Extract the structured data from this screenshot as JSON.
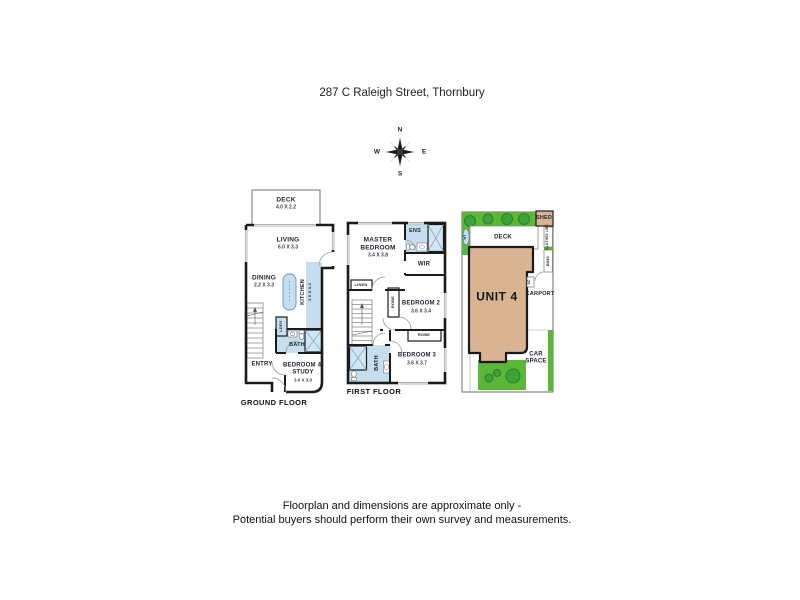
{
  "title": "287 C Raleigh Street, Thornbury",
  "compass": {
    "north": "N",
    "south": "S",
    "east": "E",
    "west": "W"
  },
  "ground_floor": {
    "floor_label": "GROUND FLOOR",
    "deck": {
      "name": "DECK",
      "dims": "4.0 X 2.2"
    },
    "living": {
      "name": "LIVING",
      "dims": "6.0 X 3.3"
    },
    "dining": {
      "name": "DINING",
      "dims": "2.2 X 3.3"
    },
    "kitchen": {
      "name": "KITCHEN",
      "dims": "2.0 X 3.3"
    },
    "laundry": {
      "name": "LDRY"
    },
    "bath": {
      "name": "BATH"
    },
    "entry": {
      "name": "ENTRY"
    },
    "bedroom4_study": {
      "name_line1": "BEDROOM 4/",
      "name_line2": "STUDY",
      "dims": "3.0 X 3.0"
    }
  },
  "first_floor": {
    "floor_label": "FIRST FLOOR",
    "master_bedroom": {
      "name_line1": "MASTER",
      "name_line2": "BEDROOM",
      "dims": "3.4 X 3.8"
    },
    "ensuite": {
      "name": "ENS"
    },
    "wir": {
      "name": "WIR"
    },
    "linen": {
      "name": "LINEN"
    },
    "robe_bedroom2": {
      "name": "ROBE"
    },
    "bedroom2": {
      "name": "BEDROOM 2",
      "dims": "3.6 X 3.4"
    },
    "robe_bedroom3": {
      "name": "ROBE"
    },
    "bedroom3": {
      "name": "BEDROOM 3",
      "dims": "3.6 X 3.7"
    },
    "bath": {
      "name": "BATH"
    }
  },
  "site_plan": {
    "unit": "UNIT 4",
    "shed": "SHED",
    "deck": "DECK",
    "water_tank": "WT",
    "clothes_line": "CLOTHES LINE",
    "bins": "BINS",
    "ac": "AC",
    "carport": "CARPORT",
    "car_space_line1": "CAR",
    "car_space_line2": "SPACE"
  },
  "disclaimer": {
    "line1": "Floorplan and dimensions are approximate only -",
    "line2": "Potential buyers should perform their own survey and measurements."
  },
  "colors": {
    "wet_area": "#c5dff0",
    "unit_fill": "#d9b492",
    "grass": "#5cb637",
    "tree": "#3ba337",
    "wall": "#1b1b1b"
  }
}
